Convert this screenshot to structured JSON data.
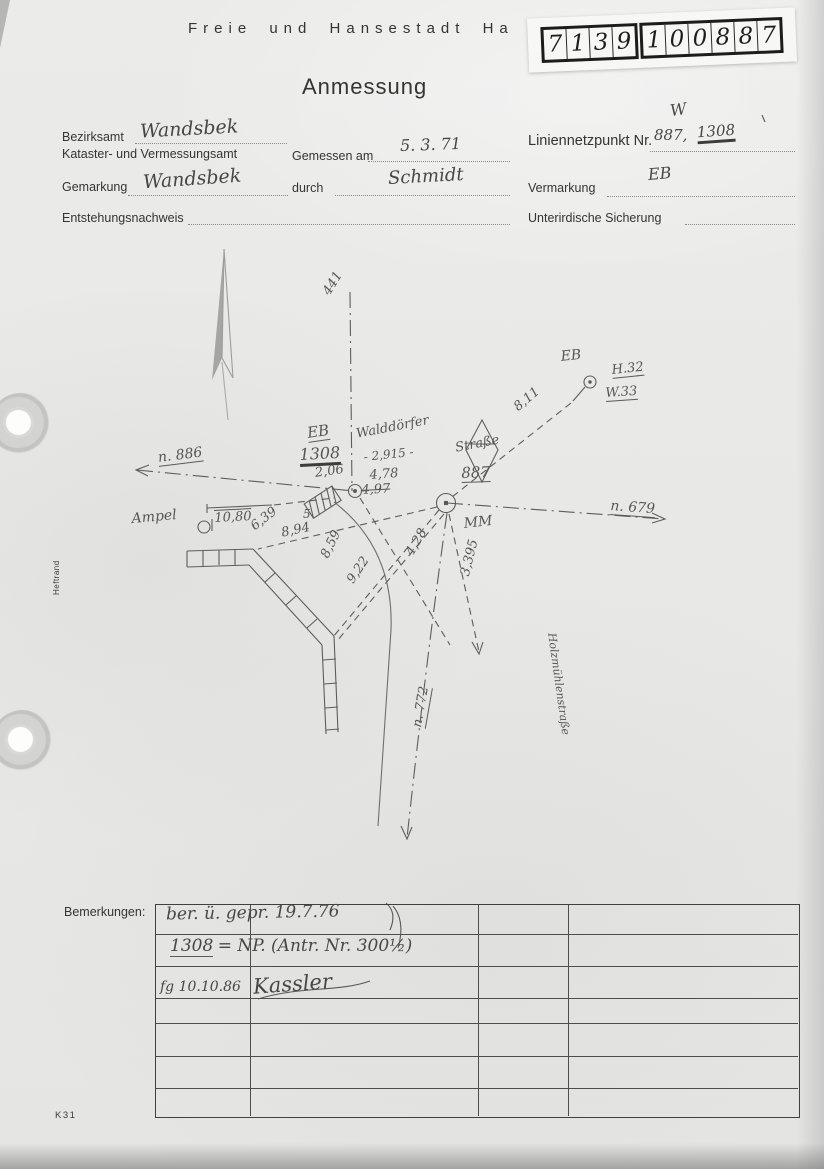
{
  "header": {
    "agency_line": "Freie und Hansestadt Ha",
    "title": "Anmessung",
    "sticker_groups": [
      [
        "7",
        "1",
        "3",
        "9"
      ],
      [
        "1",
        "0",
        "0",
        "8",
        "8",
        "7"
      ]
    ],
    "margin_label": "Heftrand",
    "form_code": "K31"
  },
  "form": {
    "bezirksamt_label": "Bezirksamt",
    "bezirksamt_value": "Wandsbek",
    "kataster_label": "Kataster- und Vermessungsamt",
    "gemessen_label": "Gemessen am",
    "gemessen_value": "5. 3. 71",
    "liniennetzpunkt_label": "Liniennetzpunkt Nr.",
    "punkt_nr_1": "887,",
    "punkt_nr_2": "1308",
    "annotation_w": "W",
    "gemarkung_label": "Gemarkung",
    "gemarkung_value": "Wandsbek",
    "durch_label": "durch",
    "durch_value": "Schmidt",
    "vermarkung_label": "Vermarkung",
    "vermarkung_value": "EB",
    "entstehungsnachweis_label": "Entstehungsnachweis",
    "unterirdische_label": "Unterirdische Sicherung"
  },
  "sketch": {
    "labels": [
      {
        "t": "441",
        "x": 320,
        "y": 290,
        "s": 13,
        "r": -58
      },
      {
        "t": "EB",
        "x": 306,
        "y": 424,
        "s": 15,
        "r": -8,
        "u": 1
      },
      {
        "t": "1308",
        "x": 299,
        "y": 445,
        "s": 16,
        "r": -3,
        "u": 2
      },
      {
        "t": "2,06",
        "x": 314,
        "y": 466,
        "s": 13,
        "r": -8
      },
      {
        "t": "4,78",
        "x": 369,
        "y": 468,
        "s": 13,
        "r": -4
      },
      {
        "t": "4,97",
        "x": 361,
        "y": 483,
        "s": 13,
        "r": -3,
        "st": 1
      },
      {
        "t": "Walddörfer",
        "x": 355,
        "y": 427,
        "s": 13,
        "r": -11
      },
      {
        "t": "Straße",
        "x": 454,
        "y": 441,
        "s": 13,
        "r": -11
      },
      {
        "t": "- 2,915 -",
        "x": 363,
        "y": 450,
        "s": 12,
        "r": -6
      },
      {
        "t": "887",
        "x": 461,
        "y": 464,
        "s": 15,
        "r": -2,
        "u": 1
      },
      {
        "t": "MM",
        "x": 463,
        "y": 516,
        "s": 14,
        "r": -6
      },
      {
        "t": "n. 886",
        "x": 157,
        "y": 450,
        "s": 14,
        "r": -7,
        "u": 1
      },
      {
        "t": "n. 679",
        "x": 611,
        "y": 498,
        "s": 14,
        "r": 4,
        "u": 1
      },
      {
        "t": "EB",
        "x": 560,
        "y": 349,
        "s": 14,
        "r": -6
      },
      {
        "t": "H.32",
        "x": 611,
        "y": 363,
        "s": 13,
        "r": -6,
        "u": 1
      },
      {
        "t": "W.33",
        "x": 605,
        "y": 386,
        "s": 13,
        "r": -4,
        "u": 1
      },
      {
        "t": "8,11",
        "x": 511,
        "y": 403,
        "s": 13,
        "r": -40
      },
      {
        "t": "Ampel",
        "x": 131,
        "y": 511,
        "s": 14,
        "r": -5
      },
      {
        "t": "10,80",
        "x": 214,
        "y": 511,
        "s": 13,
        "r": -3,
        "ov": 1
      },
      {
        "t": "6,39",
        "x": 248,
        "y": 522,
        "s": 13,
        "r": -38
      },
      {
        "t": "8,94",
        "x": 280,
        "y": 526,
        "s": 13,
        "r": -12
      },
      {
        "t": "5",
        "x": 303,
        "y": 507,
        "s": 12,
        "r": 0
      },
      {
        "t": "8,59",
        "x": 318,
        "y": 554,
        "s": 13,
        "r": -64
      },
      {
        "t": "9,22",
        "x": 344,
        "y": 578,
        "s": 13,
        "r": -56
      },
      {
        "t": "4,28",
        "x": 403,
        "y": 551,
        "s": 13,
        "r": -60
      },
      {
        "t": "3,395",
        "x": 458,
        "y": 574,
        "s": 13,
        "r": -76
      },
      {
        "t": "n. 772",
        "x": 410,
        "y": 726,
        "s": 13,
        "r": -80,
        "u": 1
      },
      {
        "t": "Holzmühlenstraße",
        "x": 558,
        "y": 632,
        "s": 11,
        "r": 82
      }
    ]
  },
  "remarks": {
    "label": "Bemerkungen:",
    "row1": "ber. ü. gepr.   19.7.76",
    "row2_num": "1308",
    "row2_rest": "= NP.    (Antr. Nr. 300½)",
    "row3_pre": "fg 10.10.86",
    "row3_sig": "Kassler"
  }
}
